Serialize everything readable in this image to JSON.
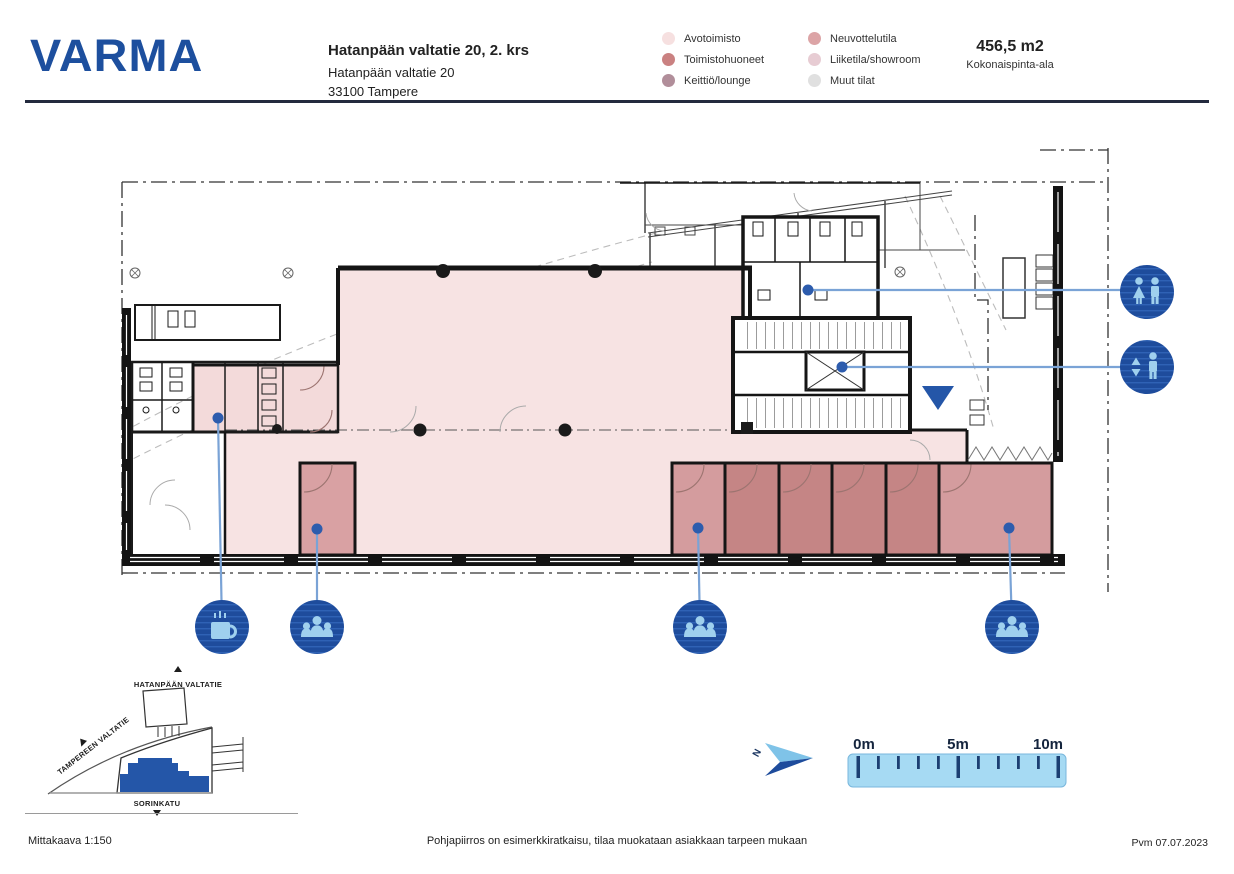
{
  "header": {
    "logo": "VARMA",
    "title": "Hatanpään valtatie 20, 2. krs",
    "address_line1": "Hatanpään valtatie 20",
    "address_line2": "33100 Tampere",
    "area_value": "456,5 m2",
    "area_label": "Kokonaispinta-ala"
  },
  "legend": {
    "items": [
      {
        "label": "Avotoimisto",
        "color": "#f6e0e0"
      },
      {
        "label": "Toimistohuoneet",
        "color": "#ca8181"
      },
      {
        "label": "Keittiö/lounge",
        "color": "#b18e9a"
      },
      {
        "label": "Neuvottelutila",
        "color": "#dca4a6"
      },
      {
        "label": "Liiketila/showroom",
        "color": "#e7ccd3"
      },
      {
        "label": "Muut tilat",
        "color": "#e0e0e0"
      }
    ]
  },
  "plan": {
    "colors": {
      "zone_open": "#f7e3e3",
      "zone_kitchen": "#f3dada",
      "zone_meeting": "#d9a1a3",
      "zone_meeting_light": "#d49c9e",
      "zone_office": "#c58585",
      "icon_bg": "#1e4c9c",
      "icon_stripe": "#2f62b5",
      "icon_glyph": "#9fd0ee",
      "leader": "#7aa3d6",
      "dot": "#2d5cad",
      "entrance_arrow": "#2456a8"
    },
    "markers": [
      {
        "name": "wc"
      },
      {
        "name": "elevator"
      },
      {
        "name": "kitchen-coffee"
      },
      {
        "name": "meeting-room"
      },
      {
        "name": "meeting-room"
      },
      {
        "name": "meeting-room"
      }
    ]
  },
  "minimap": {
    "street_top": "HATANPÄÄN VALTATIE",
    "street_left": "TAMPEREEN VALTATIE",
    "street_bottom": "SORINKATU",
    "highlight_color": "#2456a8"
  },
  "scalebar": {
    "label_0": "0m",
    "label_5": "5m",
    "label_10": "10m",
    "north_label": "N",
    "bar_color": "#a6daf3"
  },
  "footer": {
    "scale": "Mittakaava 1:150",
    "disclaimer": "Pohjapiirros on esimerkkiratkaisu, tilaa muokataan asiakkaan tarpeen mukaan",
    "date": "Pvm 07.07.2023"
  }
}
